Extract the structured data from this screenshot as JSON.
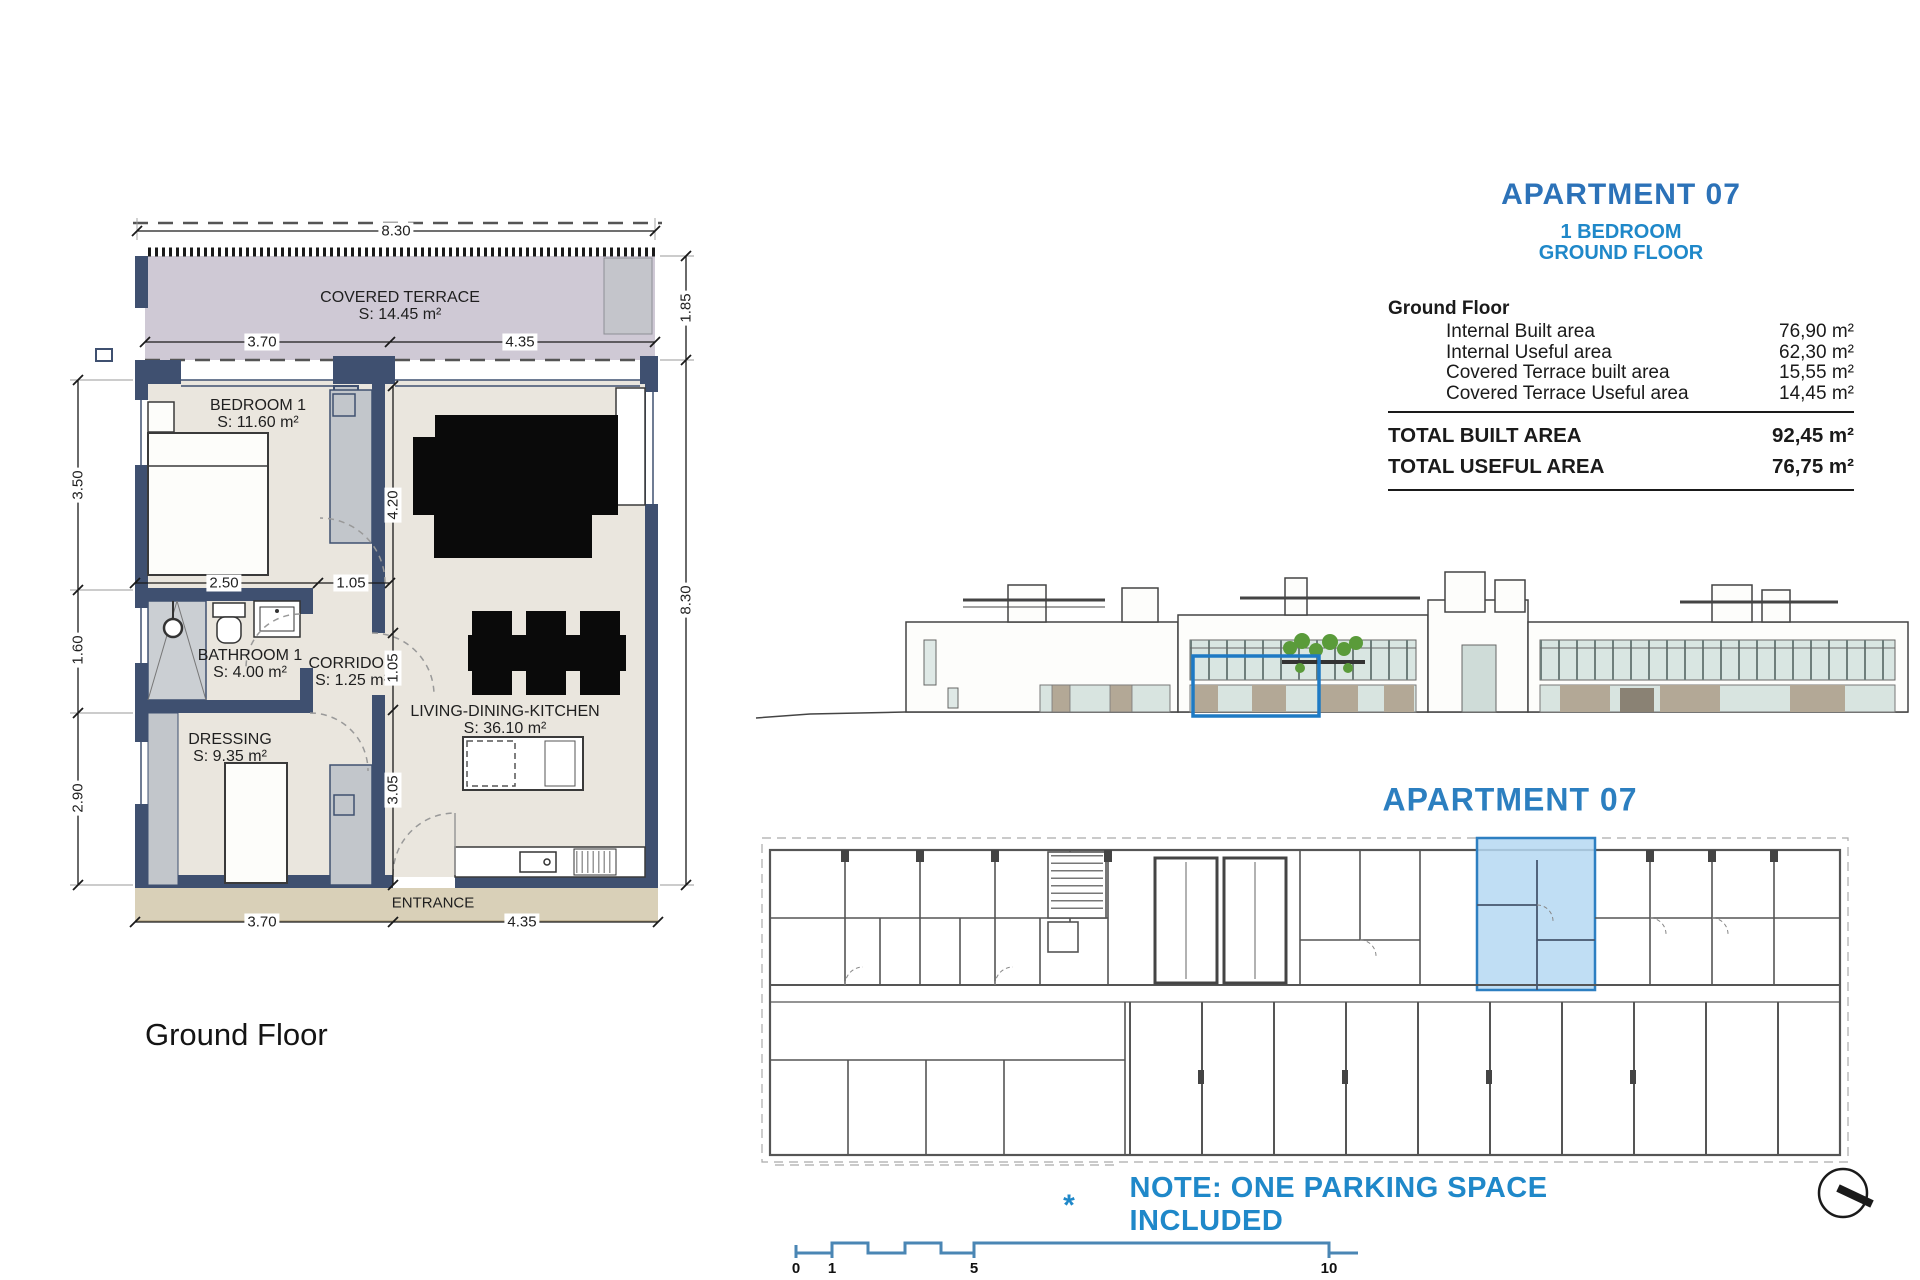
{
  "plan": {
    "caption": "Ground Floor",
    "entrance": "ENTRANCE",
    "rooms": [
      {
        "name": "COVERED TERRACE",
        "area": "S: 14.45 m²"
      },
      {
        "name": "BEDROOM 1",
        "area": "S: 11.60 m²"
      },
      {
        "name": "BATHROOM 1",
        "area": "S: 4.00 m²"
      },
      {
        "name": "CORRIDOR",
        "area": "S: 1.25 m²"
      },
      {
        "name": "DRESSING",
        "area": "S: 9.35 m²"
      },
      {
        "name": "LIVING-DINING-KITCHEN",
        "area": "S: 36.10 m²"
      }
    ],
    "dims": {
      "top_total": "8.30",
      "terrace_left": "3.70",
      "terrace_right": "4.35",
      "bed_w": "2.50",
      "corr_top": "1.05",
      "living_v": "4.20",
      "corr_v": "1.05",
      "low_v": "3.05",
      "left_a": "3.50",
      "left_b": "1.60",
      "left_c": "2.90",
      "right_a": "1.85",
      "right_b": "8.30",
      "bottom_left": "3.70",
      "bottom_right": "4.35"
    }
  },
  "info": {
    "title": "APARTMENT  07",
    "subtitle1": "1 BEDROOM",
    "subtitle2": "GROUND FLOOR",
    "table": {
      "section": "Ground Floor",
      "rows": [
        {
          "label": "Internal Built area",
          "value": "76,90 m²"
        },
        {
          "label": "Internal Useful area",
          "value": "62,30 m²"
        },
        {
          "label": "Covered Terrace built area",
          "value": "15,55 m²"
        },
        {
          "label": "Covered Terrace Useful area",
          "value": "14,45 m²"
        }
      ],
      "totals": [
        {
          "label": "TOTAL BUILT AREA",
          "value": "92,45 m²"
        },
        {
          "label": "TOTAL USEFUL AREA",
          "value": "76,75 m²"
        }
      ]
    }
  },
  "site": {
    "label": "APARTMENT 07"
  },
  "note": {
    "star": "*",
    "text": "NOTE: ONE PARKING SPACE INCLUDED"
  },
  "scalebar": {
    "labels": [
      "0",
      "1",
      "5",
      "10"
    ]
  },
  "colors": {
    "title_blue": "#2c72b8",
    "cyan_blue": "#1f88c9",
    "wall_navy": "#3f5070",
    "terrace_fill": "#cfc9d5",
    "floor_fill": "#eae6de",
    "highlight_fill": "#b5d8f2",
    "highlight_stroke": "#2d7fc1"
  }
}
